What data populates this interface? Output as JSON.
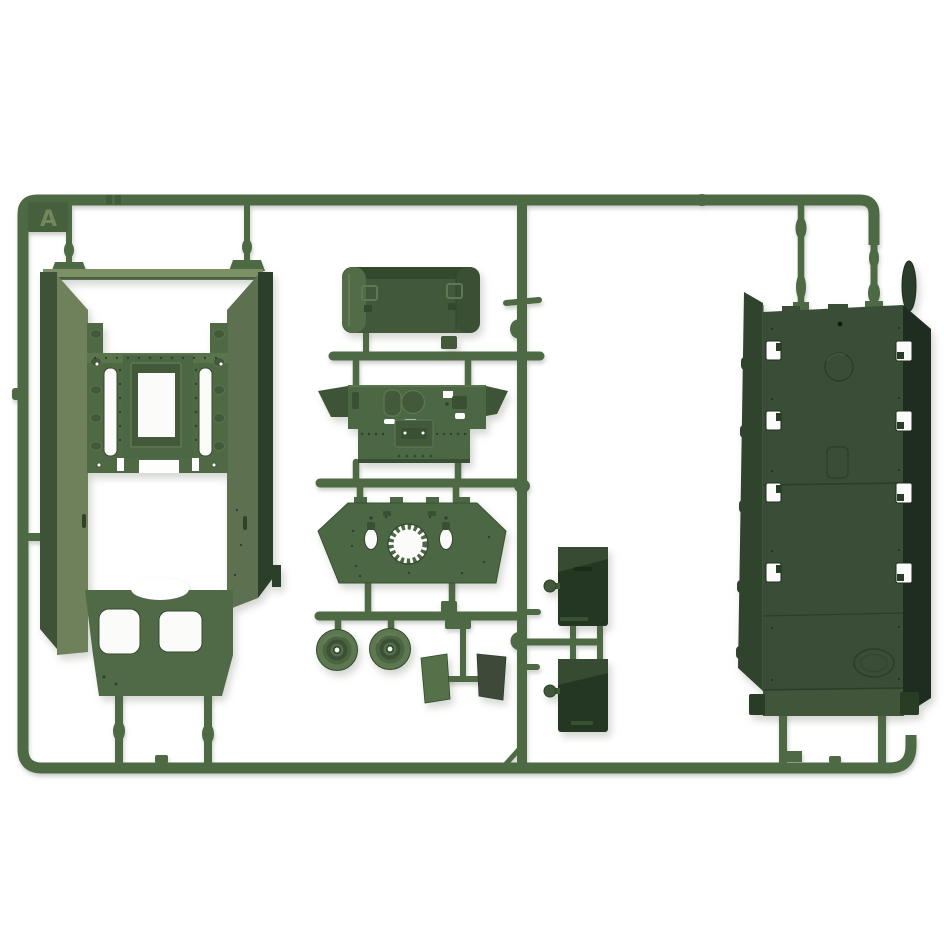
{
  "scene": {
    "type": "product photo",
    "subject": "olive-green injection-molded model kit sprue (parts tree) with armored-vehicle parts on a white background",
    "background": "#ffffff",
    "tab_letter": "A"
  },
  "sprue": {
    "frame_shape": "rounded rectangle runner frame",
    "parts": [
      {
        "id": "hull-tub",
        "desc": "large open hull tub with mounting frame, twin slots and twin hatch cutouts",
        "count": 1
      },
      {
        "id": "stowage-box",
        "desc": "rounded rectangular stowage bin with two latch fittings",
        "count": 1
      },
      {
        "id": "glacis-plate",
        "desc": "winged glacis plate with round and rectangular hatches",
        "count": 1
      },
      {
        "id": "turret-deck",
        "desc": "trapezoid deck plate with toothed turret-ring opening and two oval holes",
        "count": 1
      },
      {
        "id": "road-wheel",
        "desc": "dished road wheel with open hub",
        "count": 2
      },
      {
        "id": "mud-flap",
        "desc": "flat rectangular mud-flap plate",
        "count": 2
      },
      {
        "id": "fuel-tank",
        "desc": "dark rectangular external fuel tank with side knob",
        "count": 2
      },
      {
        "id": "belly-panel",
        "desc": "long hull belly panel with slotted edge holes, embossed disc and oval logo",
        "count": 1
      },
      {
        "id": "idler-disc",
        "desc": "thin wheel disc seen edge-on",
        "count": 1
      }
    ]
  },
  "palette": {
    "white": "#ffffff",
    "holeWhite": "#fbfcf9",
    "runner": "#4e6a45",
    "runnerDark": "#3a5233",
    "runnerLight": "#6a8158",
    "tab": "#46603d",
    "letter": "#72875c",
    "tubTop": "#7d8f64",
    "wallLight": "#6f815a",
    "wallMid": "#5d7150",
    "wallDark": "#3e5237",
    "wallDarkest": "#2c3f2b",
    "deck": "#4f6945",
    "deckRail": "#5a744c",
    "inset": "#42593a",
    "plate": "#4c6743",
    "band": "#506947",
    "wing": "#3d5536",
    "detail": "#3a5033",
    "deep": "#33492e",
    "boxFace": "#42583b",
    "capLight": "#526c47",
    "capDark": "#3a4f33",
    "flapLight": "#56704a",
    "flapDark": "#3e493a",
    "tank": "#243722",
    "tankBevel": "#364b31",
    "knob": "#42583a",
    "strap": "#1b2b19",
    "block": "#43593a",
    "wheelOuter": "#5d7850",
    "wheelMid": "#4b6441",
    "wheelInner": "#3b5035",
    "wheelHub": "#546f49",
    "panelFace": "#3a4d37",
    "panelFlange": "#30442d",
    "panelWall": "#1e2d1f",
    "panelBand": "#40553a",
    "panelDark": "#293c26",
    "discDark": "#2a3d2b",
    "lineDark": "#2b3e28",
    "lineLight": "#4a6143",
    "rivet": "#2f432b",
    "edgeLight": "#5e7951",
    "ink": "#0e1c10"
  }
}
